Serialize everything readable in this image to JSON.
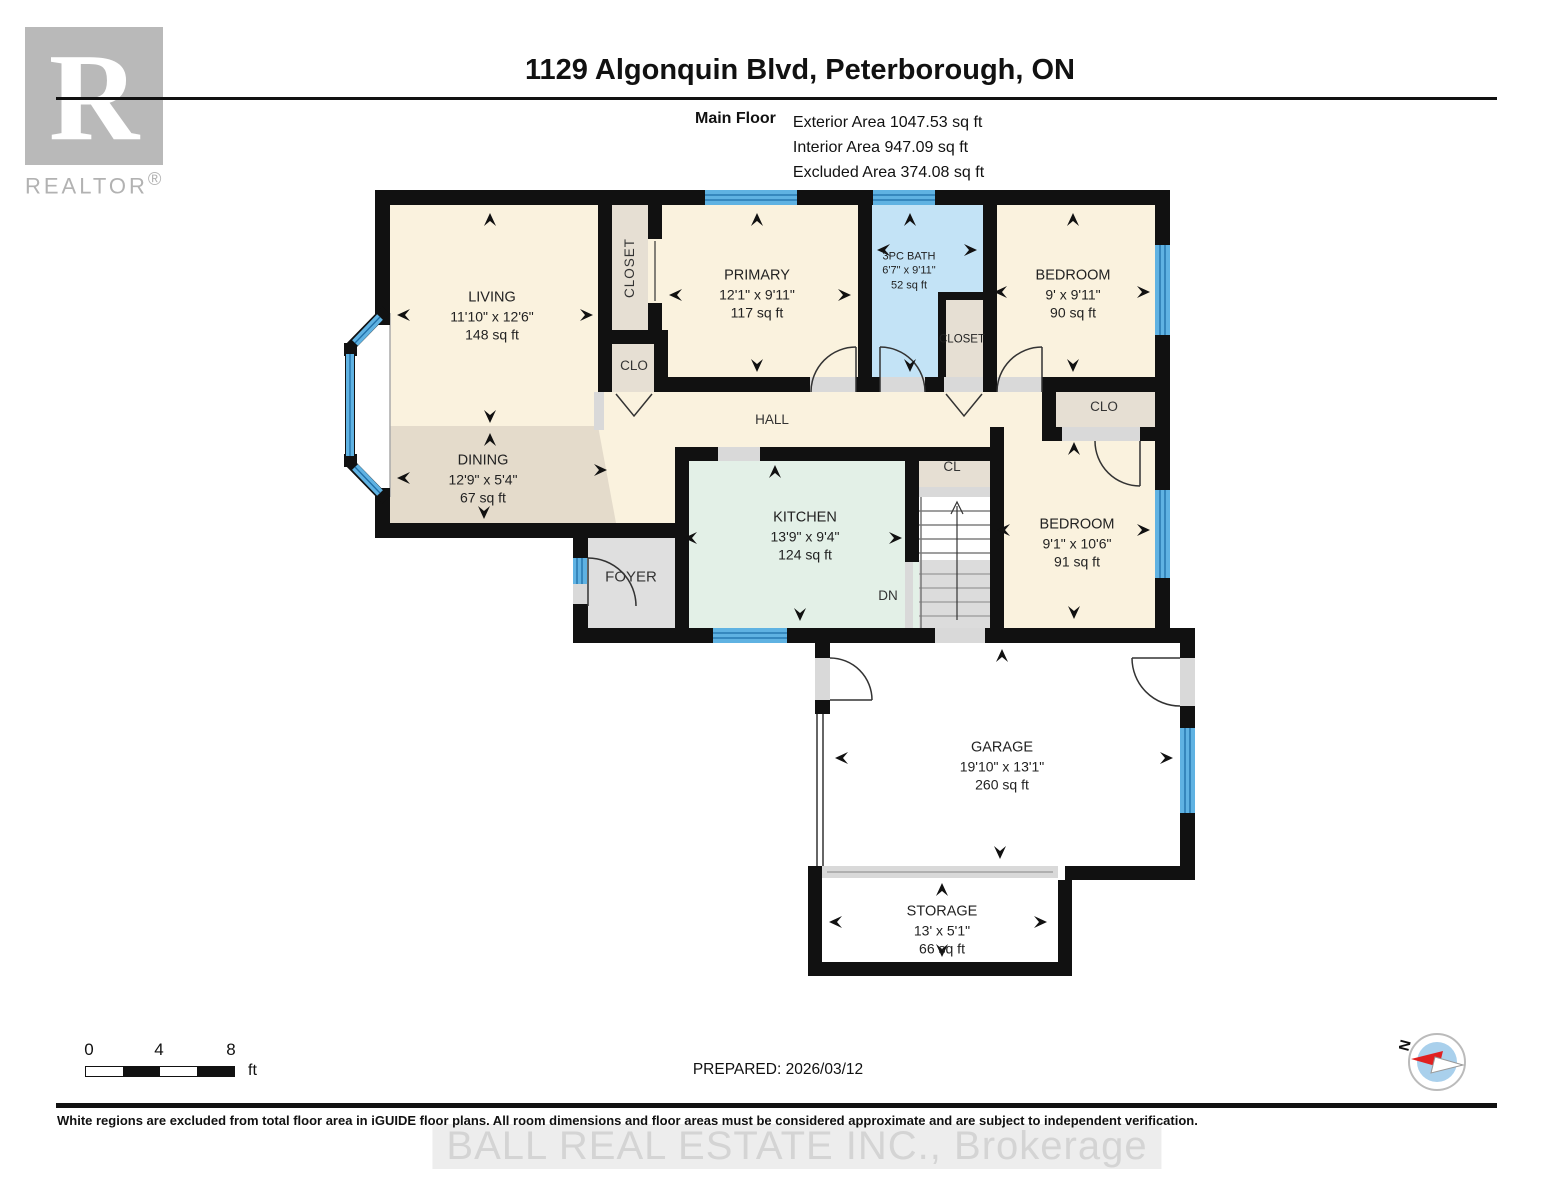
{
  "header": {
    "title": "1129 Algonquin Blvd, Peterborough, ON",
    "floor_label": "Main Floor",
    "area_lines": [
      "Exterior Area 1047.53 sq ft",
      "Interior Area 947.09 sq ft",
      "Excluded Area 374.08 sq ft"
    ]
  },
  "logo": {
    "glyph": "R",
    "brand": "REALTOR",
    "registered": "®"
  },
  "rooms": {
    "living": {
      "name": "LIVING",
      "dims": "11'10\" x 12'6\"",
      "area": "148 sq ft"
    },
    "dining": {
      "name": "DINING",
      "dims": "12'9\" x 5'4\"",
      "area": "67 sq ft"
    },
    "primary": {
      "name": "PRIMARY",
      "dims": "12'1\" x 9'11\"",
      "area": "117 sq ft"
    },
    "bath": {
      "name": "3PC BATH",
      "dims": "6'7\" x 9'11\"",
      "area": "52 sq ft"
    },
    "bedroom1": {
      "name": "BEDROOM",
      "dims": "9' x 9'11\"",
      "area": "90 sq ft"
    },
    "bedroom2": {
      "name": "BEDROOM",
      "dims": "9'1\" x 10'6\"",
      "area": "91 sq ft"
    },
    "kitchen": {
      "name": "KITCHEN",
      "dims": "13'9\" x 9'4\"",
      "area": "124 sq ft"
    },
    "garage": {
      "name": "GARAGE",
      "dims": "19'10\" x 13'1\"",
      "area": "260 sq ft"
    },
    "storage": {
      "name": "STORAGE",
      "dims": "13' x 5'1\"",
      "area": "66 sq ft"
    },
    "hall": {
      "name": "HALL"
    },
    "foyer": {
      "name": "FOYER"
    },
    "closet_left": {
      "name": "CLOSET"
    },
    "closet_bath": {
      "name": "CLOSET"
    },
    "clo_left": {
      "name": "CLO"
    },
    "clo_right": {
      "name": "CLO"
    },
    "cl": {
      "name": "CL"
    },
    "stairs": {
      "label": "DN"
    }
  },
  "scale_bar": {
    "ticks": [
      "0",
      "4",
      "8"
    ],
    "unit": "ft"
  },
  "footer": {
    "prepared": "PREPARED: 2026/03/12",
    "disclaimer": "White regions are excluded from total floor area in iGUIDE floor plans. All room dimensions and floor areas must be considered approximate and are subject to independent verification.",
    "watermark": "BALL REAL ESTATE INC., Brokerage"
  },
  "compass": {
    "north_label": "N"
  },
  "colors": {
    "wall": "#111111",
    "room_cream": "#FAF2DE",
    "room_beige": "#E4DBCB",
    "closet_beige": "#E6DFD3",
    "bath_blue": "#C3E3F6",
    "kitchen_green": "#E3F0E7",
    "floor_gray": "#DFDFDF",
    "window_blue": "#5FB2E2",
    "window_line": "#1F6FA8"
  }
}
